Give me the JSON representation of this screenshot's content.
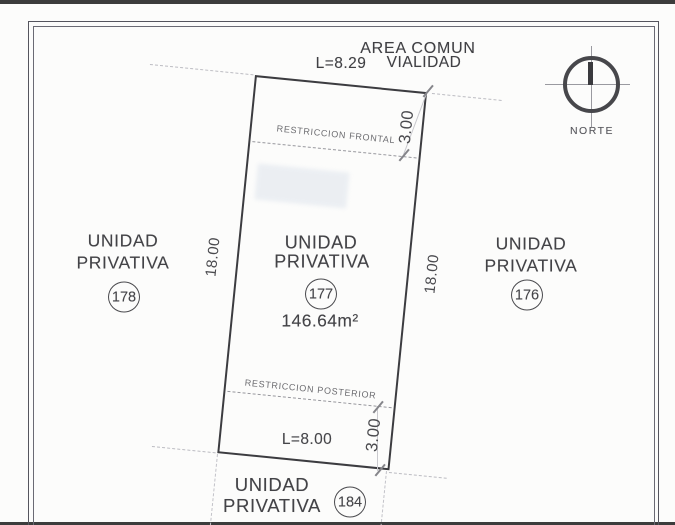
{
  "title_block": {
    "area_comun": "AREA COMUN",
    "l_top": "L=8.29",
    "vialidad": "VIALIDAD"
  },
  "north": {
    "label": "NORTE"
  },
  "parcel": {
    "unidad": "UNIDAD",
    "privativa": "PRIVATIVA",
    "number": "177",
    "area": "146.64m²",
    "restriccion_frontal": "RESTRICCION FRONTAL",
    "restriccion_posterior": "RESTRICCION POSTERIOR",
    "l_bottom": "L=8.00",
    "dim_left": "18.00",
    "dim_right": "18.00",
    "dim_front_setback": "3.00",
    "dim_rear_setback": "3.00"
  },
  "neighbors": {
    "left": {
      "unidad": "UNIDAD",
      "privativa": "PRIVATIVA",
      "number": "178"
    },
    "right": {
      "unidad": "UNIDAD",
      "privativa": "PRIVATIVA",
      "number": "176"
    },
    "bottom": {
      "unidad": "UNIDAD",
      "privativa": "PRIVATIVA",
      "number": "184"
    }
  },
  "colors": {
    "parcel_line": "#3c3c40",
    "page_border": "#55555e",
    "dashed_line": "#bcbcc2",
    "text": "#46464a",
    "smudge": "#ccd6e4"
  }
}
